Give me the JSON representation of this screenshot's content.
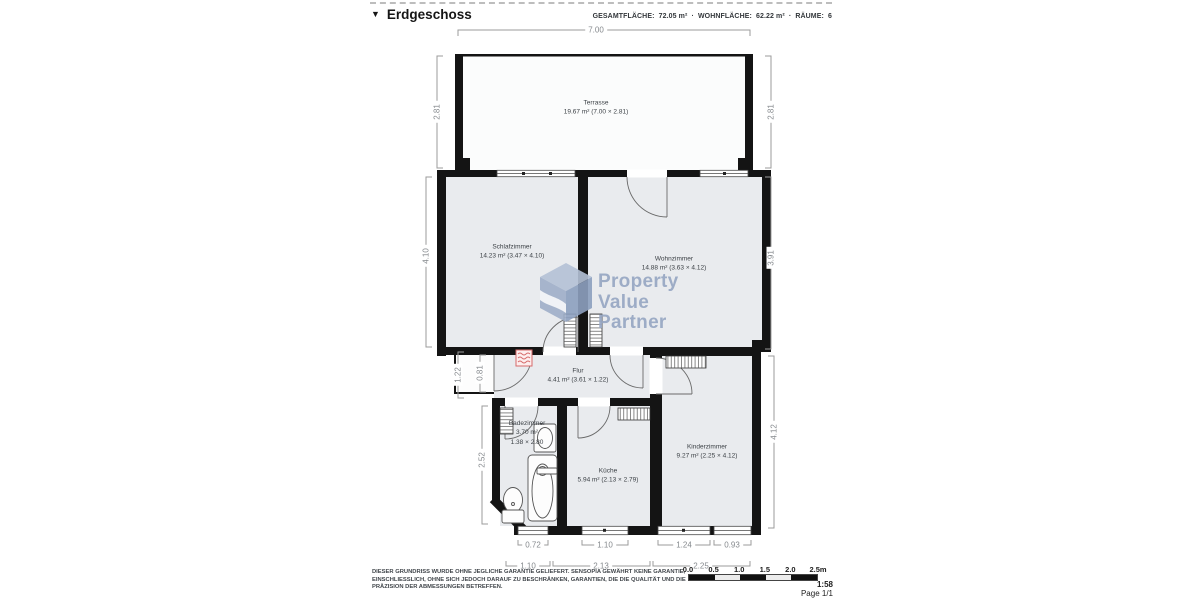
{
  "header": {
    "title": "Erdgeschoss",
    "marker": "▼",
    "separator": "·",
    "stats": [
      {
        "label": "GESAMTFLÄCHE:",
        "value": "72.05 m²"
      },
      {
        "label": "WOHNFLÄCHE:",
        "value": "62.22 m²"
      },
      {
        "label": "RÄUME:",
        "value": "6"
      }
    ]
  },
  "watermark": {
    "line1": "Property",
    "line2": "Value",
    "line3": "Partner"
  },
  "rooms": {
    "terrasse": {
      "name": "Terrasse",
      "detail": "19.67 m² (7.00 × 2.81)"
    },
    "schlafzimmer": {
      "name": "Schlafzimmer",
      "detail": "14.23 m² (3.47 × 4.10)"
    },
    "wohnzimmer": {
      "name": "Wohnzimmer",
      "detail": "14.88 m² (3.63 × 4.12)"
    },
    "flur": {
      "name": "Flur",
      "detail": "4.41 m² (3.61 × 1.22)"
    },
    "badezimmer": {
      "name": "Badezimmer",
      "detail": "3.70 m²",
      "detail2": "1.38 × 2.80"
    },
    "kueche": {
      "name": "Küche",
      "detail": "5.94 m² (2.13 × 2.79)"
    },
    "kinderzimmer": {
      "name": "Kinderzimmer",
      "detail": "9.27 m² (2.25 × 4.12)"
    }
  },
  "dimensions": {
    "top_width": "7.00",
    "terrace_left": "2.81",
    "terrace_right": "2.81",
    "schlafzimmer_left": "4.10",
    "wohnzimmer_right": "3.91",
    "flur_left": "1.22",
    "flur_left_inner": "0.81",
    "badezimmer_left": "2.52",
    "kinderzimmer_right": "4.12",
    "bottom_inner": [
      "0.72",
      "1.10",
      "1.24",
      "0.93"
    ],
    "bottom_outer": [
      "1.10",
      "2.13",
      "2.25"
    ]
  },
  "scalebar": {
    "ticks": [
      "0.0",
      "0.5",
      "1.0",
      "1.5",
      "2.0",
      "2.5m"
    ],
    "ratio": "1:58",
    "page": "Page 1/1"
  },
  "disclaimer": "DIESER GRUNDRISS WURDE OHNE JEGLICHE GARANTIE GELIEFERT. SENSOPIA GEWÄHRT KEINE GARANTIE, EINSCHLIESSLICH, OHNE SICH JEDOCH DARAUF ZU BESCHRÄNKEN, GARANTIEN, DIE DIE QUALITÄT UND DIE PRÄZISION DER ABMESSUNGEN BETREFFEN.",
  "colors": {
    "wall": "#141414",
    "room_fill": "#e9ebee",
    "dimension_gray": "#9b9b9b",
    "radiator_red": "#d66a6a",
    "watermark_blue": "#9aabc7"
  }
}
